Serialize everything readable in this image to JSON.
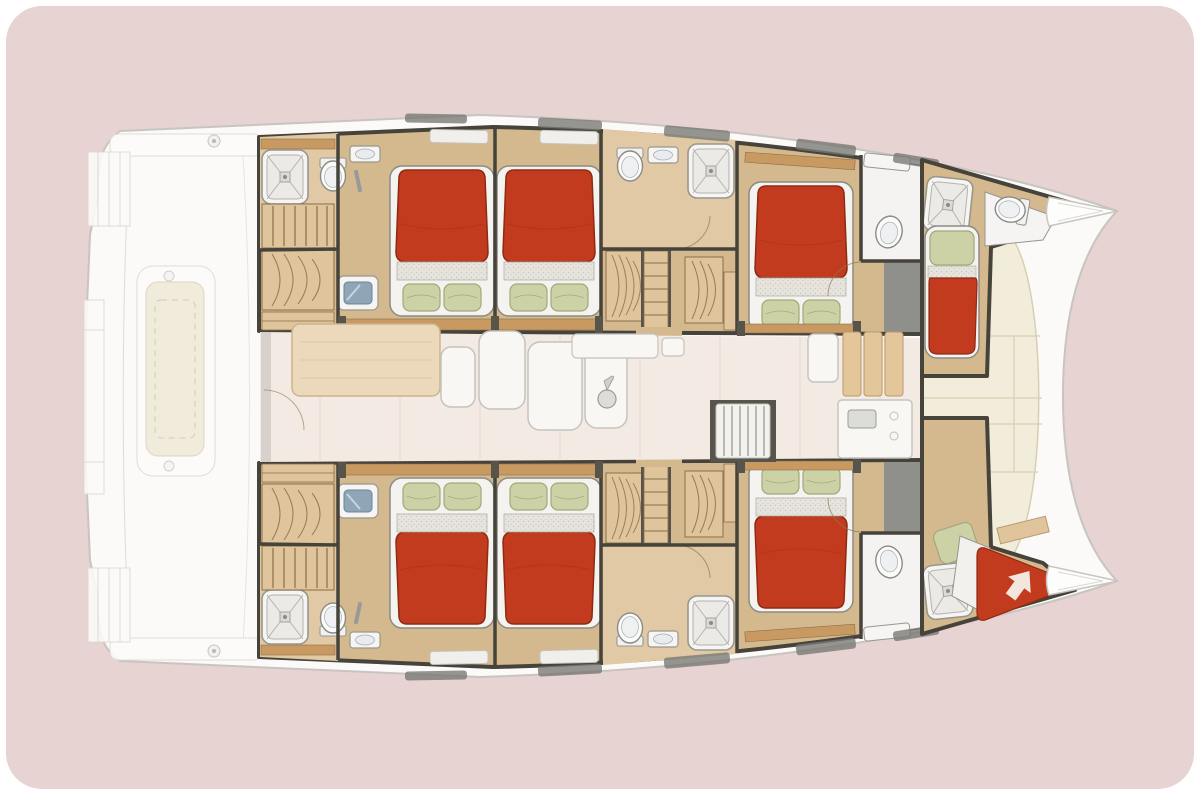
{
  "floor_plan": {
    "vessel_type": "sailing catamaran",
    "view": "overhead deck / accommodation plan",
    "bow_direction": "right",
    "hulls": [
      "port hull (top)",
      "starboard hull (bottom)"
    ],
    "accommodation_summary": {
      "double_cabins": 6,
      "bow_berth_cabins": 2,
      "bathrooms": 6,
      "showers": 8,
      "toilets": 6,
      "washbasins": 6
    },
    "port_hull_rooms": [
      "aft bathroom with shower cubicle, toilet and washbasin",
      "steps and wardrobe with shelves",
      "aft double cabin with island bed and vanity",
      "mid double cabin with island bed",
      "en-suite bathroom with toilet, washbasin and shower cubicle",
      "wardrobes and companion steps",
      "forward double cabin with washbasin corner",
      "bow cabin with single berth, shower cubicle and toilet"
    ],
    "starboard_hull_rooms": [
      "aft bathroom with shower cubicle, toilet and washbasin",
      "steps and wardrobe with shelves",
      "aft double cabin with island bed and vanity",
      "mid double cabin with island bed",
      "en-suite bathroom with toilet, washbasin and shower cubicle",
      "wardrobes and companion steps",
      "forward double cabin with washbasin corner",
      "bow cabin with angled berth, shower cubicle and access arrow"
    ],
    "beds": [
      {
        "id": "port-aft-double",
        "type": "double",
        "pillows": 2,
        "head_faces": "centerline"
      },
      {
        "id": "port-mid-double",
        "type": "double",
        "pillows": 2,
        "head_faces": "centerline"
      },
      {
        "id": "port-forward-double",
        "type": "double",
        "pillows": 2,
        "head_faces": "centerline"
      },
      {
        "id": "port-bow-single",
        "type": "single",
        "pillows": 1,
        "head_faces": "aft"
      },
      {
        "id": "starboard-aft-double",
        "type": "double",
        "pillows": 2,
        "head_faces": "centerline"
      },
      {
        "id": "starboard-mid-double",
        "type": "double",
        "pillows": 2,
        "head_faces": "centerline"
      },
      {
        "id": "starboard-forward-double",
        "type": "double",
        "pillows": 2,
        "head_faces": "centerline"
      },
      {
        "id": "starboard-bow-angled",
        "type": "single",
        "pillows": 1,
        "head_faces": "aft",
        "marking": "white access arrow pointing to bow"
      }
    ],
    "saloon": {
      "features": [
        "dining table",
        "L-shaped sofa seats",
        "console shelf",
        "teardrop sink",
        "companionway stairs",
        "refrigerator island",
        "galley worktop with cutting boards",
        "galley counter with sink"
      ]
    },
    "cockpit": {
      "rendering": "faded / greyed-out aft deck",
      "features": [
        "cockpit table",
        "bench seats",
        "transom steps port and starboard",
        "aft platform",
        "deck fittings"
      ]
    },
    "foredeck": {
      "features": [
        "paneled sun deck between bows",
        "locker seams",
        "angled teak step"
      ]
    },
    "bow_tips": 2,
    "windows_per_side": 5
  },
  "palette": {
    "page": "#ffffff",
    "bg": "#e6d3d2",
    "hull_white": "#fbfaf8",
    "hull_outline": "#c8c5c0",
    "deck_line": "#dbd8d3",
    "cockpit_table": "#efe9d6",
    "floor_wood": "#d4b88e",
    "floor_wood_light": "#e0c9a4",
    "wood_trim": "#c89a62",
    "wood_dark": "#8a6f4a",
    "shelf_wood": "#dfc49c",
    "wall": "#46433b",
    "grey_void": "#8f8f8c",
    "steps_dark": "#57544c",
    "window_grey": "#787873",
    "saloon_floor": "#f3eae3",
    "tile_line": "#e2d6cb",
    "foredeck": "#f2edda",
    "foredeck_line": "#d8cfb2",
    "table_wood": "#ecd9bc",
    "seat_white": "#f8f7f4",
    "seat_outline": "#c5c3bd",
    "fixture_white": "#f6f5f3",
    "fixture_outline": "#97978f",
    "vanity_blue": "#8fa6b8",
    "bed_red": "#c23b1e",
    "bed_red_dark": "#8e2a12",
    "sheet": "#e7e4de",
    "sheet_dot": "#c9c5bd",
    "pillow": "#cdd1a6",
    "pillow_outline": "#a3a87c",
    "arrow_white": "#f6f0e8",
    "shadow": "#b9b4ae"
  }
}
